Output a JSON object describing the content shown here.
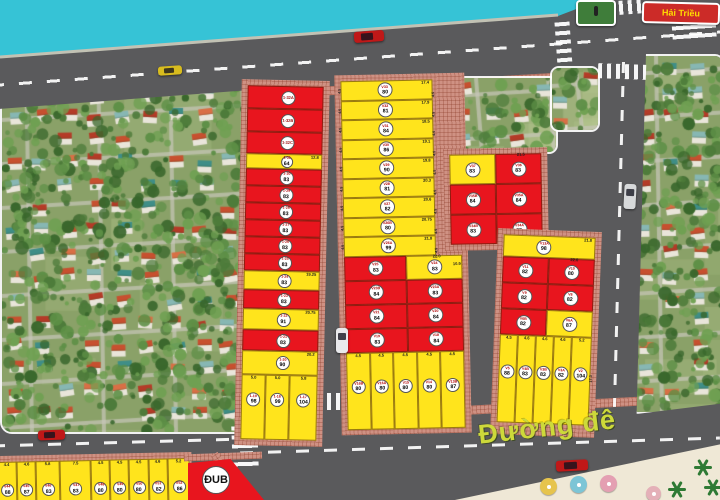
{
  "labels": {
    "dike_road": "Đường đê",
    "street_sign": "Hải Triều",
    "public_plot": "ĐUB"
  },
  "colors": {
    "water": "#36c3d6",
    "road": "#5a5a5c",
    "plot_red": "#e8151e",
    "plot_yellow": "#ffe41c",
    "sidewalk": "#cf9183",
    "sign_bg": "#cc2b28",
    "sign_text": "#ffdd00",
    "road_label_text": "#cdd93a"
  },
  "left_column": {
    "strips": [
      {
        "color": "red",
        "code": "1-32A",
        "area": "",
        "dim": "",
        "h": 23
      },
      {
        "color": "red",
        "code": "1-32B",
        "area": "",
        "dim": "",
        "h": 23
      },
      {
        "color": "red",
        "code": "1-32C",
        "area": "",
        "dim": "",
        "h": 22
      },
      {
        "color": "yellow",
        "code": "1-31",
        "area": "64",
        "dim": "12.8",
        "h": 15
      },
      {
        "color": "red",
        "code": "1-30",
        "area": "83",
        "dim": "",
        "h": 17
      },
      {
        "color": "red",
        "code": "1-29",
        "area": "83",
        "dim": "",
        "h": 17
      },
      {
        "color": "red",
        "code": "1-28",
        "area": "83",
        "dim": "",
        "h": 17
      },
      {
        "color": "red",
        "code": "1-27",
        "area": "83",
        "dim": "",
        "h": 17
      },
      {
        "color": "red",
        "code": "1-26",
        "area": "83",
        "dim": "",
        "h": 17
      },
      {
        "color": "red",
        "code": "1-25",
        "area": "83",
        "dim": "",
        "h": 17
      },
      {
        "color": "yellow",
        "code": "1-24",
        "area": "83",
        "dim": "19.25",
        "h": 19
      },
      {
        "color": "red",
        "code": "1-23",
        "area": "83",
        "dim": "",
        "h": 19
      },
      {
        "color": "yellow",
        "code": "1-22",
        "area": "91",
        "dim": "20.75",
        "h": 21
      },
      {
        "color": "red",
        "code": "1-21",
        "area": "83",
        "dim": "",
        "h": 21
      },
      {
        "color": "yellow",
        "code": "1-20",
        "area": "90",
        "dim": "20.2",
        "h": 24
      }
    ],
    "bottom_plots": [
      {
        "color": "yellow",
        "code": "1-19",
        "area": "98",
        "dim": "5.0"
      },
      {
        "color": "yellow",
        "code": "1-18",
        "area": "99",
        "dim": "5.0"
      },
      {
        "color": "yellow",
        "code": "1-17",
        "area": "104",
        "dim": "5.8"
      }
    ]
  },
  "middle_block": {
    "side_dim": "4.5",
    "top_strips": [
      {
        "color": "yellow",
        "code": "V33",
        "area": "80",
        "dim": "17.4"
      },
      {
        "color": "yellow",
        "code": "V32",
        "area": "81",
        "dim": "17.9"
      },
      {
        "color": "yellow",
        "code": "V31",
        "area": "84",
        "dim": "18.5"
      },
      {
        "color": "yellow",
        "code": "V30",
        "area": "86",
        "dim": "19.1"
      },
      {
        "color": "yellow",
        "code": "V29",
        "area": "90",
        "dim": "19.8"
      },
      {
        "color": "yellow",
        "code": "V28",
        "area": "81",
        "dim": "20.3"
      },
      {
        "color": "yellow",
        "code": "V27",
        "area": "82",
        "dim": "20.6"
      },
      {
        "color": "yellow",
        "code": "V26B",
        "area": "80",
        "dim": "20.75"
      },
      {
        "color": "yellow",
        "code": "V26A",
        "area": "99",
        "dim": "21.8"
      }
    ],
    "grid_top_dim": "22.0",
    "grid_right_dim": "10.9",
    "grid": [
      [
        {
          "color": "red",
          "code": "V25",
          "area": "83"
        },
        {
          "color": "yellow",
          "code": "V24",
          "area": "83"
        }
      ],
      [
        {
          "color": "red",
          "code": "V23B",
          "area": "84"
        },
        {
          "color": "red",
          "code": "V23A",
          "area": "83"
        }
      ],
      [
        {
          "color": "red",
          "code": "V21",
          "area": "84"
        },
        {
          "color": "red",
          "code": "V20",
          "area": "84"
        }
      ],
      [
        {
          "color": "red",
          "code": "V19",
          "area": "83"
        },
        {
          "color": "red",
          "code": "V18",
          "area": "84"
        }
      ]
    ],
    "bottom_plots": [
      {
        "color": "yellow",
        "code": "V16B",
        "area": "80",
        "dim": "4.5"
      },
      {
        "color": "yellow",
        "code": "V16A",
        "area": "80",
        "dim": "4.5"
      },
      {
        "color": "yellow",
        "code": "V15",
        "area": "80",
        "dim": "4.5"
      },
      {
        "color": "yellow",
        "code": "V14",
        "area": "80",
        "dim": "4.5"
      },
      {
        "color": "yellow",
        "code": "V13B",
        "area": "87",
        "dim": "4.5"
      }
    ]
  },
  "upper_block": {
    "top_dim": "21.5",
    "grid": [
      [
        {
          "color": "yellow",
          "code": "V37",
          "area": "83"
        },
        {
          "color": "red",
          "code": "V36",
          "area": "83"
        }
      ],
      [
        {
          "color": "red",
          "code": "V35B",
          "area": "84"
        },
        {
          "color": "red",
          "code": "V35A",
          "area": "84"
        }
      ],
      [
        {
          "color": "red",
          "code": "V34B",
          "area": "83"
        },
        {
          "color": "red",
          "code": "V34A",
          "area": "83"
        }
      ]
    ]
  },
  "right_column": {
    "top_strip": {
      "color": "yellow",
      "code": "V13A",
      "area": "98",
      "dim": "21.8"
    },
    "grid_top_dim": "22.0",
    "side_dim": "17.3",
    "grid": [
      [
        {
          "color": "red",
          "code": "V11",
          "area": "82"
        },
        {
          "color": "red",
          "code": "V10",
          "area": "80"
        }
      ],
      [
        {
          "color": "red",
          "code": "V9",
          "area": "82"
        },
        {
          "color": "red",
          "code": "V8",
          "area": "82"
        }
      ],
      [
        {
          "color": "red",
          "code": "V6B",
          "area": "82"
        },
        {
          "color": "yellow",
          "code": "V6A",
          "area": "87"
        }
      ]
    ],
    "bottom_plots": [
      {
        "color": "yellow",
        "code": "V5",
        "area": "88",
        "dim": "4.5"
      },
      {
        "color": "yellow",
        "code": "V4B",
        "area": "83",
        "dim": "4.6"
      },
      {
        "color": "yellow",
        "code": "V3B",
        "area": "83",
        "dim": "4.6"
      },
      {
        "color": "yellow",
        "code": "V3A",
        "area": "82",
        "dim": "4.6"
      },
      {
        "color": "yellow",
        "code": "V2",
        "area": "104",
        "dim": "5.2"
      }
    ]
  },
  "bottom_row": {
    "plots": [
      {
        "color": "yellow",
        "code": "V44",
        "area": "88",
        "dim": "4.4"
      },
      {
        "color": "yellow",
        "code": "V45",
        "area": "87",
        "dim": "4.6"
      },
      {
        "color": "yellow",
        "code": "V46",
        "area": "83",
        "dim": "5.8"
      },
      {
        "color": "yellow",
        "code": "V47",
        "area": "83",
        "dim": "7.5"
      },
      {
        "color": "yellow",
        "code": "V48",
        "area": "80",
        "dim": "4.5"
      },
      {
        "color": "yellow",
        "code": "V49",
        "area": "80",
        "dim": "4.5"
      },
      {
        "color": "yellow",
        "code": "V50",
        "area": "80",
        "dim": "4.5"
      },
      {
        "color": "yellow",
        "code": "V51",
        "area": "82",
        "dim": "4.6"
      },
      {
        "color": "yellow",
        "code": "V52",
        "area": "86",
        "dim": "5.2"
      }
    ]
  }
}
